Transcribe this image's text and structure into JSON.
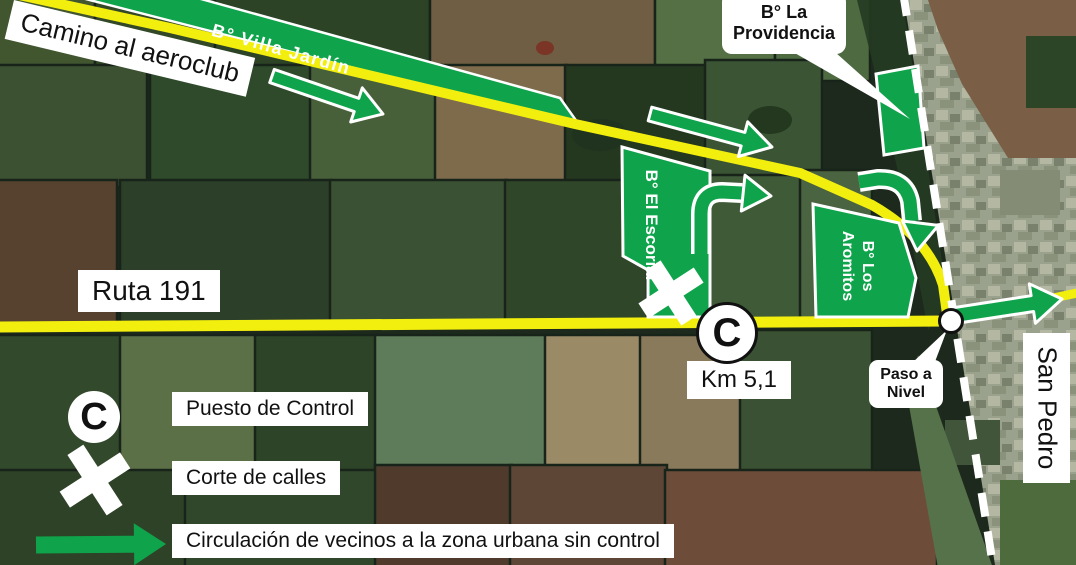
{
  "colors": {
    "overlay_green": "#0FA44B",
    "road_yellow": "#F2EE0E",
    "railway_white": "#FFFFFF",
    "label_bg": "#FFFFFF",
    "label_text": "#111111"
  },
  "roads": {
    "camino_label": "Camino al aeroclub",
    "ruta_label": "Ruta 191",
    "km_label": "Km 5,1"
  },
  "barrios": {
    "villa_jardin": "B° Villa Jardín",
    "providencia": {
      "line1": "B° La",
      "line2": "Providencia"
    },
    "el_escorial": "B° El Escorial",
    "aromitos": {
      "line1": "B° Los",
      "line2": "Aromitos"
    }
  },
  "markers": {
    "control_letter": "C",
    "crossing_callout": {
      "line1": "Paso a",
      "line2": "Nivel"
    },
    "destination_label": "San Pedro"
  },
  "legend": {
    "control": {
      "letter": "C",
      "label": "Puesto de Control"
    },
    "closure": {
      "label": "Corte de calles"
    },
    "circulation": {
      "label": "Circulación de vecinos a la zona urbana sin control"
    }
  }
}
